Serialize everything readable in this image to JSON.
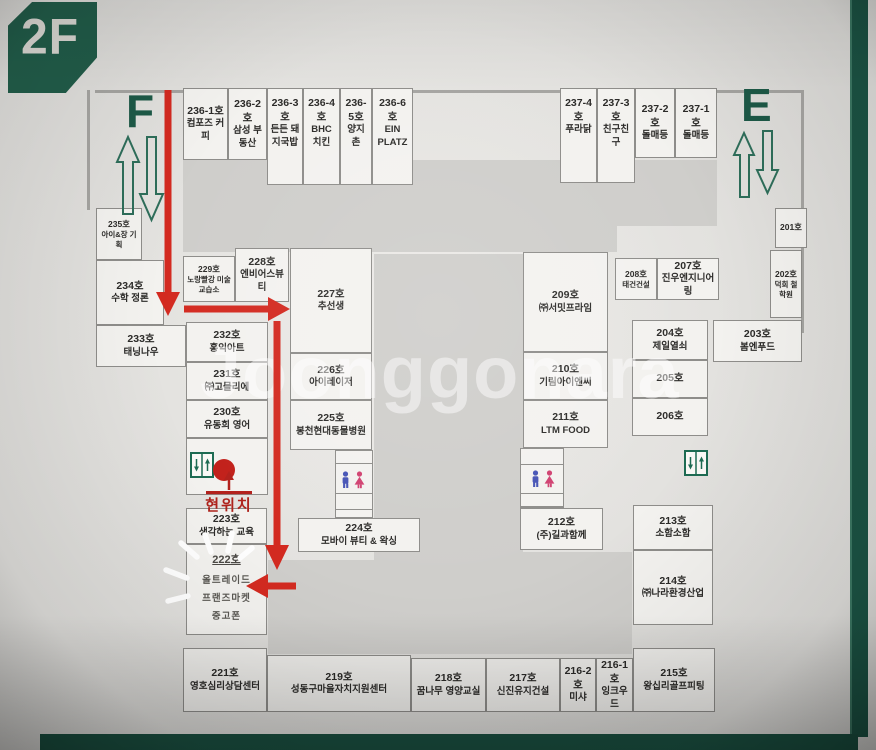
{
  "floor_label": "2F",
  "watermark": "Joonggonara",
  "stairs": {
    "f": "F",
    "e": "E"
  },
  "current_location_label": "현위치",
  "colors": {
    "accent_green": "#215c49",
    "route_red": "#d32a20",
    "restroom_male": "#4553b5",
    "restroom_female": "#d04070"
  },
  "units": [
    {
      "no": "236-1호",
      "name": "컴포즈 커피"
    },
    {
      "no": "236-2호",
      "name": "삼성 부동산"
    },
    {
      "no": "236-3호",
      "name": "든든 돼지국밥"
    },
    {
      "no": "236-4호",
      "name": "BHC 치킨"
    },
    {
      "no": "236-5호",
      "name": "양지촌"
    },
    {
      "no": "236-6호",
      "name": "EIN PLATZ"
    },
    {
      "no": "237-4호",
      "name": "푸라닭"
    },
    {
      "no": "237-3호",
      "name": "친구친구"
    },
    {
      "no": "237-2호",
      "name": "돌매등"
    },
    {
      "no": "237-1호",
      "name": "돌매등"
    },
    {
      "no": "235호",
      "name": "아이&장 기획"
    },
    {
      "no": "234호",
      "name": "수학 정론"
    },
    {
      "no": "233호",
      "name": "태닝나우"
    },
    {
      "no": "232호",
      "name": "홍익아트"
    },
    {
      "no": "231호",
      "name": "㈜고믈리에"
    },
    {
      "no": "230호",
      "name": "유동희 영어"
    },
    {
      "no": "229호",
      "name": "노랑빨강 미술교습소"
    },
    {
      "no": "228호",
      "name": "엔비어스뷰티"
    },
    {
      "no": "227호",
      "name": "추선생"
    },
    {
      "no": "226호",
      "name": "아이레이저"
    },
    {
      "no": "225호",
      "name": "봉천현대동물병원"
    },
    {
      "no": "224호",
      "name": "모바이 뷰티 & 왁싱"
    },
    {
      "no": "223호",
      "name": "생각하는 교육"
    },
    {
      "no": "222호",
      "name": "올트레이드\n프랜즈마켓\n중고폰"
    },
    {
      "no": "221호",
      "name": "영호심리상담센터"
    },
    {
      "no": "219호",
      "name": "성동구마을자치지원센터"
    },
    {
      "no": "218호",
      "name": "꿈나무 영양교실"
    },
    {
      "no": "217호",
      "name": "신진유지건설"
    },
    {
      "no": "216-2호",
      "name": "미샤"
    },
    {
      "no": "216-1호",
      "name": "잉크우드"
    },
    {
      "no": "215호",
      "name": "왕십리골프피팅"
    },
    {
      "no": "214호",
      "name": "㈜나라환경산업"
    },
    {
      "no": "213호",
      "name": "소함소함"
    },
    {
      "no": "212호",
      "name": "(주)길과함께"
    },
    {
      "no": "211호",
      "name": "LTM FOOD"
    },
    {
      "no": "210호",
      "name": "기림아이엔씨"
    },
    {
      "no": "209호",
      "name": "㈜서밋프라임"
    },
    {
      "no": "208호",
      "name": "태건건설"
    },
    {
      "no": "207호",
      "name": "진우엔지니어링"
    },
    {
      "no": "206호",
      "name": ""
    },
    {
      "no": "205호",
      "name": ""
    },
    {
      "no": "204호",
      "name": "제일열쇠"
    },
    {
      "no": "203호",
      "name": "봄엔푸드"
    },
    {
      "no": "202호",
      "name": "덕희 철학원"
    },
    {
      "no": "201호",
      "name": ""
    }
  ]
}
